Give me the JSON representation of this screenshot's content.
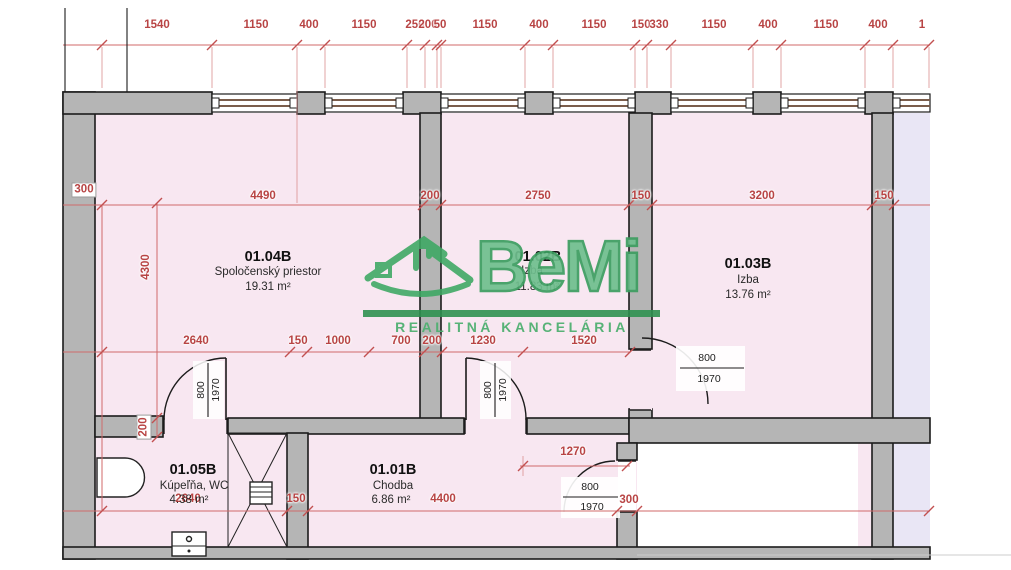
{
  "brand": {
    "name": "BeMi",
    "tagline": "REALITNÁ KANCELÁRIA"
  },
  "rooms": [
    {
      "id": "01.04B",
      "name": "Spoločenský priestor",
      "area": "19.31 m²"
    },
    {
      "id": "01.02B",
      "name": "Izba",
      "area": "11.83 m²"
    },
    {
      "id": "01.03B",
      "name": "Izba",
      "area": "13.76 m²"
    },
    {
      "id": "01.05B",
      "name": "Kúpeľňa, WC",
      "area": "4.38 m²"
    },
    {
      "id": "01.01B",
      "name": "Chodba",
      "area": "6.86 m²"
    }
  ],
  "dimensions": {
    "top": [
      "1540",
      "1150",
      "400",
      "1150",
      "250",
      "200",
      "50",
      "1150",
      "400",
      "1150",
      "150",
      "330",
      "1150",
      "400",
      "1150",
      "400",
      "1"
    ],
    "mid": [
      "300",
      "4490",
      "200",
      "2750",
      "150",
      "3200",
      "150"
    ],
    "left": [
      "4300",
      "200"
    ],
    "inner": [
      "2640",
      "150",
      "1000",
      "700",
      "200",
      "1230",
      "1520"
    ],
    "bottom": [
      "2640",
      "150",
      "4400",
      "1270",
      "300"
    ],
    "door_width": "800",
    "door_height": "1970"
  },
  "colors": {
    "room_pink": "#f8e7f1",
    "room_lavender": "#e9e6f5",
    "wall_gray": "#b5b5b5",
    "line_black": "#1c1c1c",
    "dimension_red": "#b84444",
    "window_brown": "#7b5d4b",
    "brand_green": "#3c9e60",
    "brand_green_light": "#6fbf8e"
  }
}
